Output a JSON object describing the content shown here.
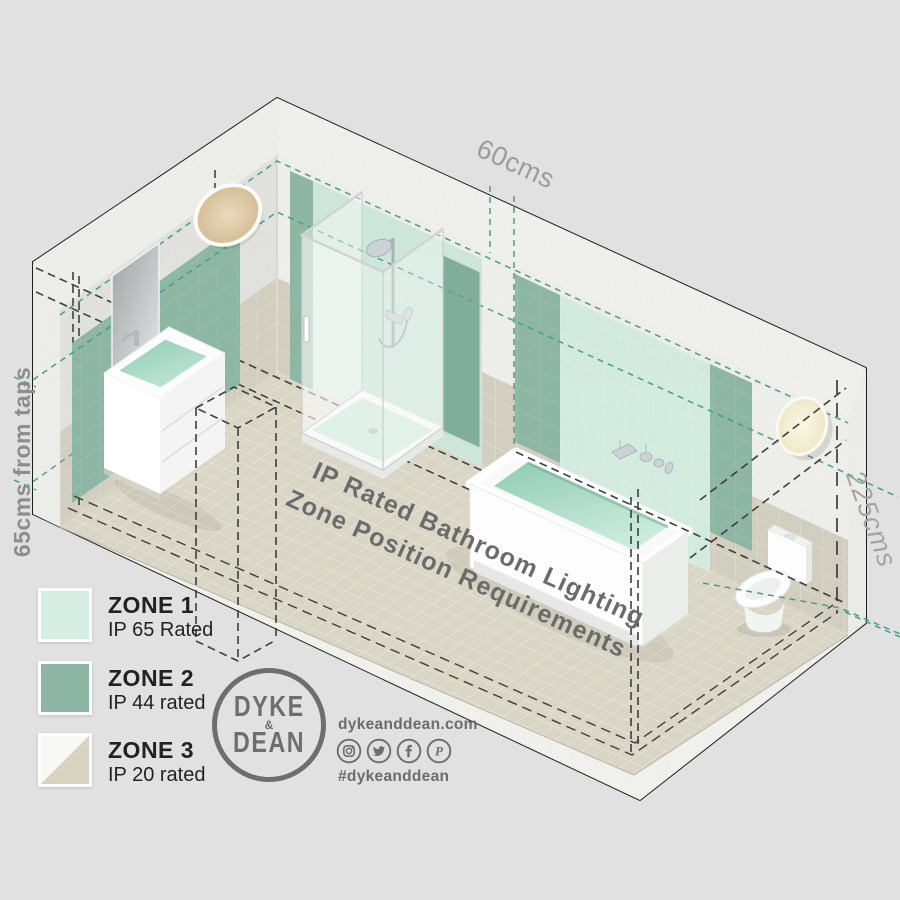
{
  "floor_title": {
    "line1": "IP Rated Bathroom Lighting",
    "line2": "Zone Position Requirements"
  },
  "dimensions": {
    "width_label": "60cms",
    "height_label": "225cms",
    "tap_label": "65cms from taps"
  },
  "legend": {
    "items": [
      {
        "zone": "ZONE 1",
        "rating": "IP 65 Rated",
        "color": "#d6ede3"
      },
      {
        "zone": "ZONE 2",
        "rating": "IP 44 rated",
        "color": "#8db7a4"
      },
      {
        "zone": "ZONE 3",
        "rating": "IP 20 rated",
        "color_top": "#f8f8f5",
        "color_bottom": "#d8d3c3"
      }
    ]
  },
  "brand": {
    "logo_line1": "DYKE",
    "logo_amp": "&",
    "logo_line2": "DEAN",
    "website": "dykeanddean.com",
    "hashtag": "#dykeanddean",
    "social_icons": [
      "instagram-icon",
      "twitter-icon",
      "facebook-icon",
      "pinterest-icon"
    ]
  },
  "colors": {
    "background": "#e1e1e1",
    "zone1_mint": "#cfe9dc",
    "zone2_green": "#8db7a4",
    "zone3_beige": "#d8d3c3",
    "teal_dash": "#4a9d89",
    "black_dash": "#3d3d3d",
    "title_grey": "#6b6b6b",
    "dim_grey": "#9c9c9c",
    "brand_grey": "#6e6e6e"
  }
}
